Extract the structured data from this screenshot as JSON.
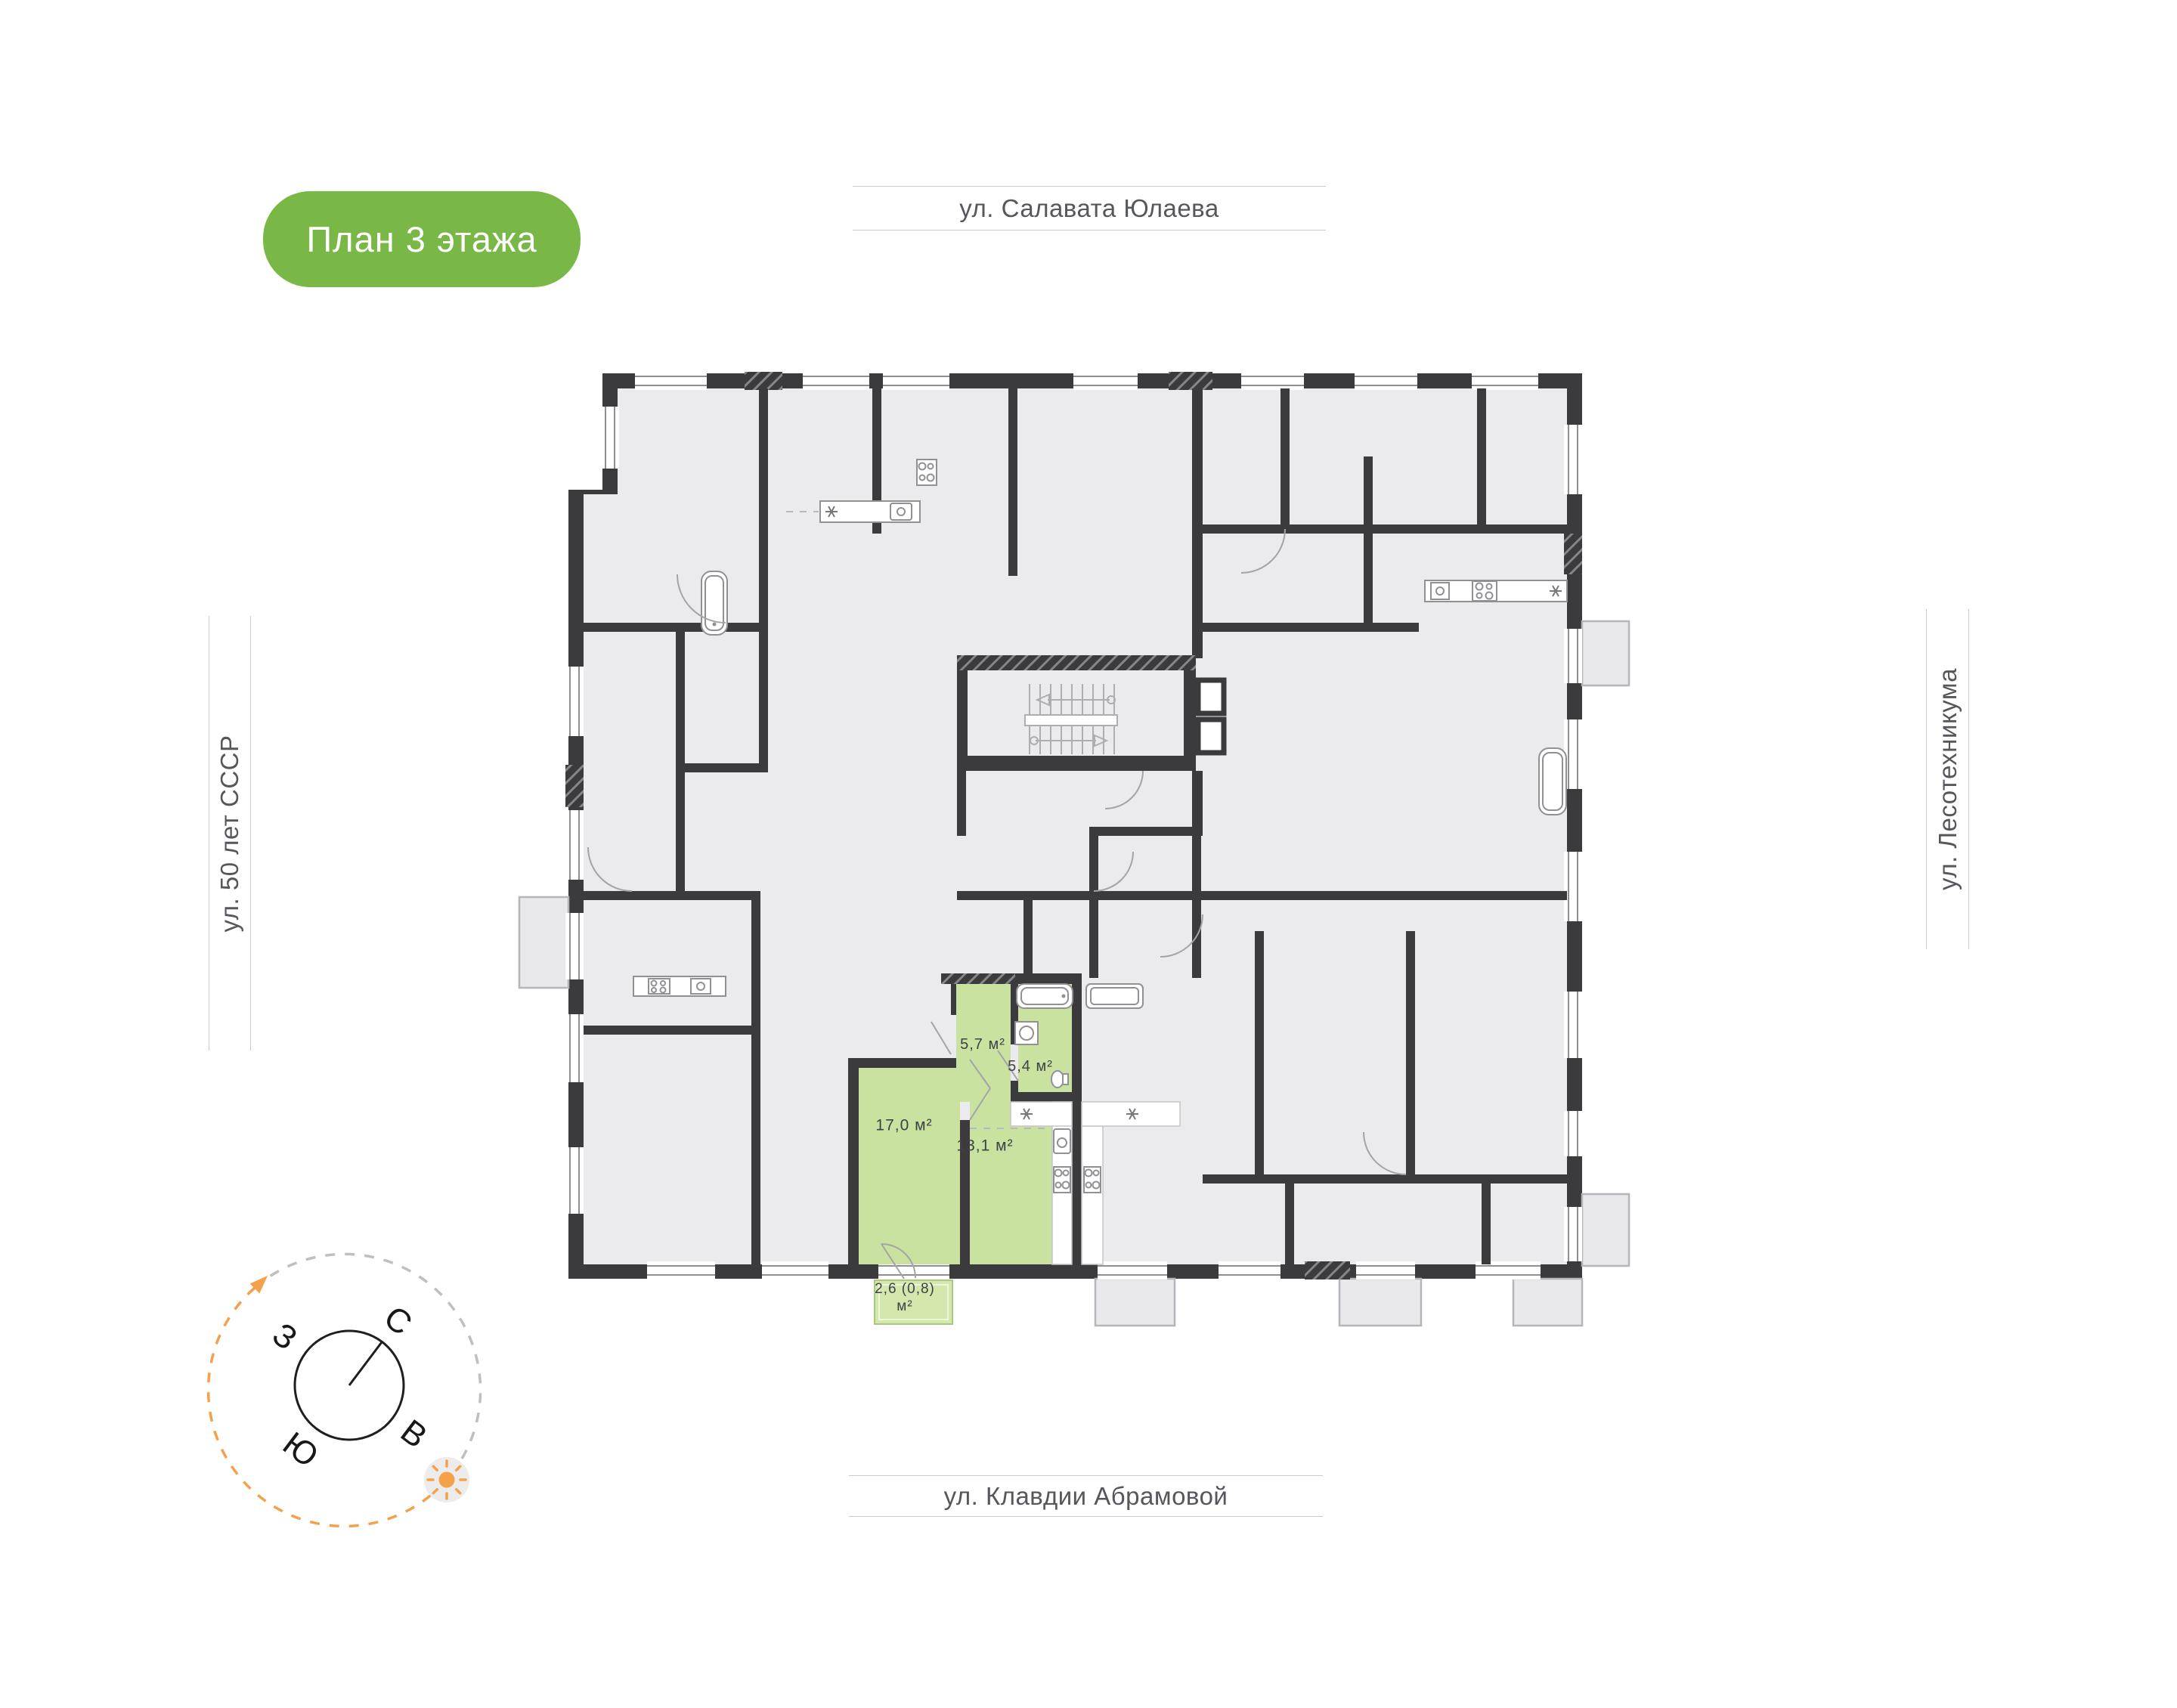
{
  "badge": {
    "label": "План 3 этажа"
  },
  "streets": {
    "top": "ул. Салавата Юлаева",
    "left": "ул. 50 лет СССР",
    "right": "ул. Лесотехникума",
    "bottom": "ул. Клавдии Абрамовой"
  },
  "highlighted_apartment": {
    "rooms": [
      {
        "id": "hallway",
        "area_label": "5,7 м²"
      },
      {
        "id": "bathroom",
        "area_label": "5,4 м²"
      },
      {
        "id": "living-room",
        "area_label": "17,0 м²"
      },
      {
        "id": "kitchen-living",
        "area_label": "13,1 м²"
      }
    ],
    "balcony": {
      "area_line1": "2,6 (0,8)",
      "area_line2": "м²"
    }
  },
  "compass": {
    "north": "С",
    "east": "В",
    "south": "Ю",
    "west": "З"
  },
  "colors": {
    "accent_green": "#79B847",
    "apartment_green": "#C9E2A0",
    "balcony_green": "#D4E8AE",
    "wall_dark": "#3B3B3D",
    "room_fill": "#EBEBEE",
    "compass_orange": "#F5A04B"
  }
}
